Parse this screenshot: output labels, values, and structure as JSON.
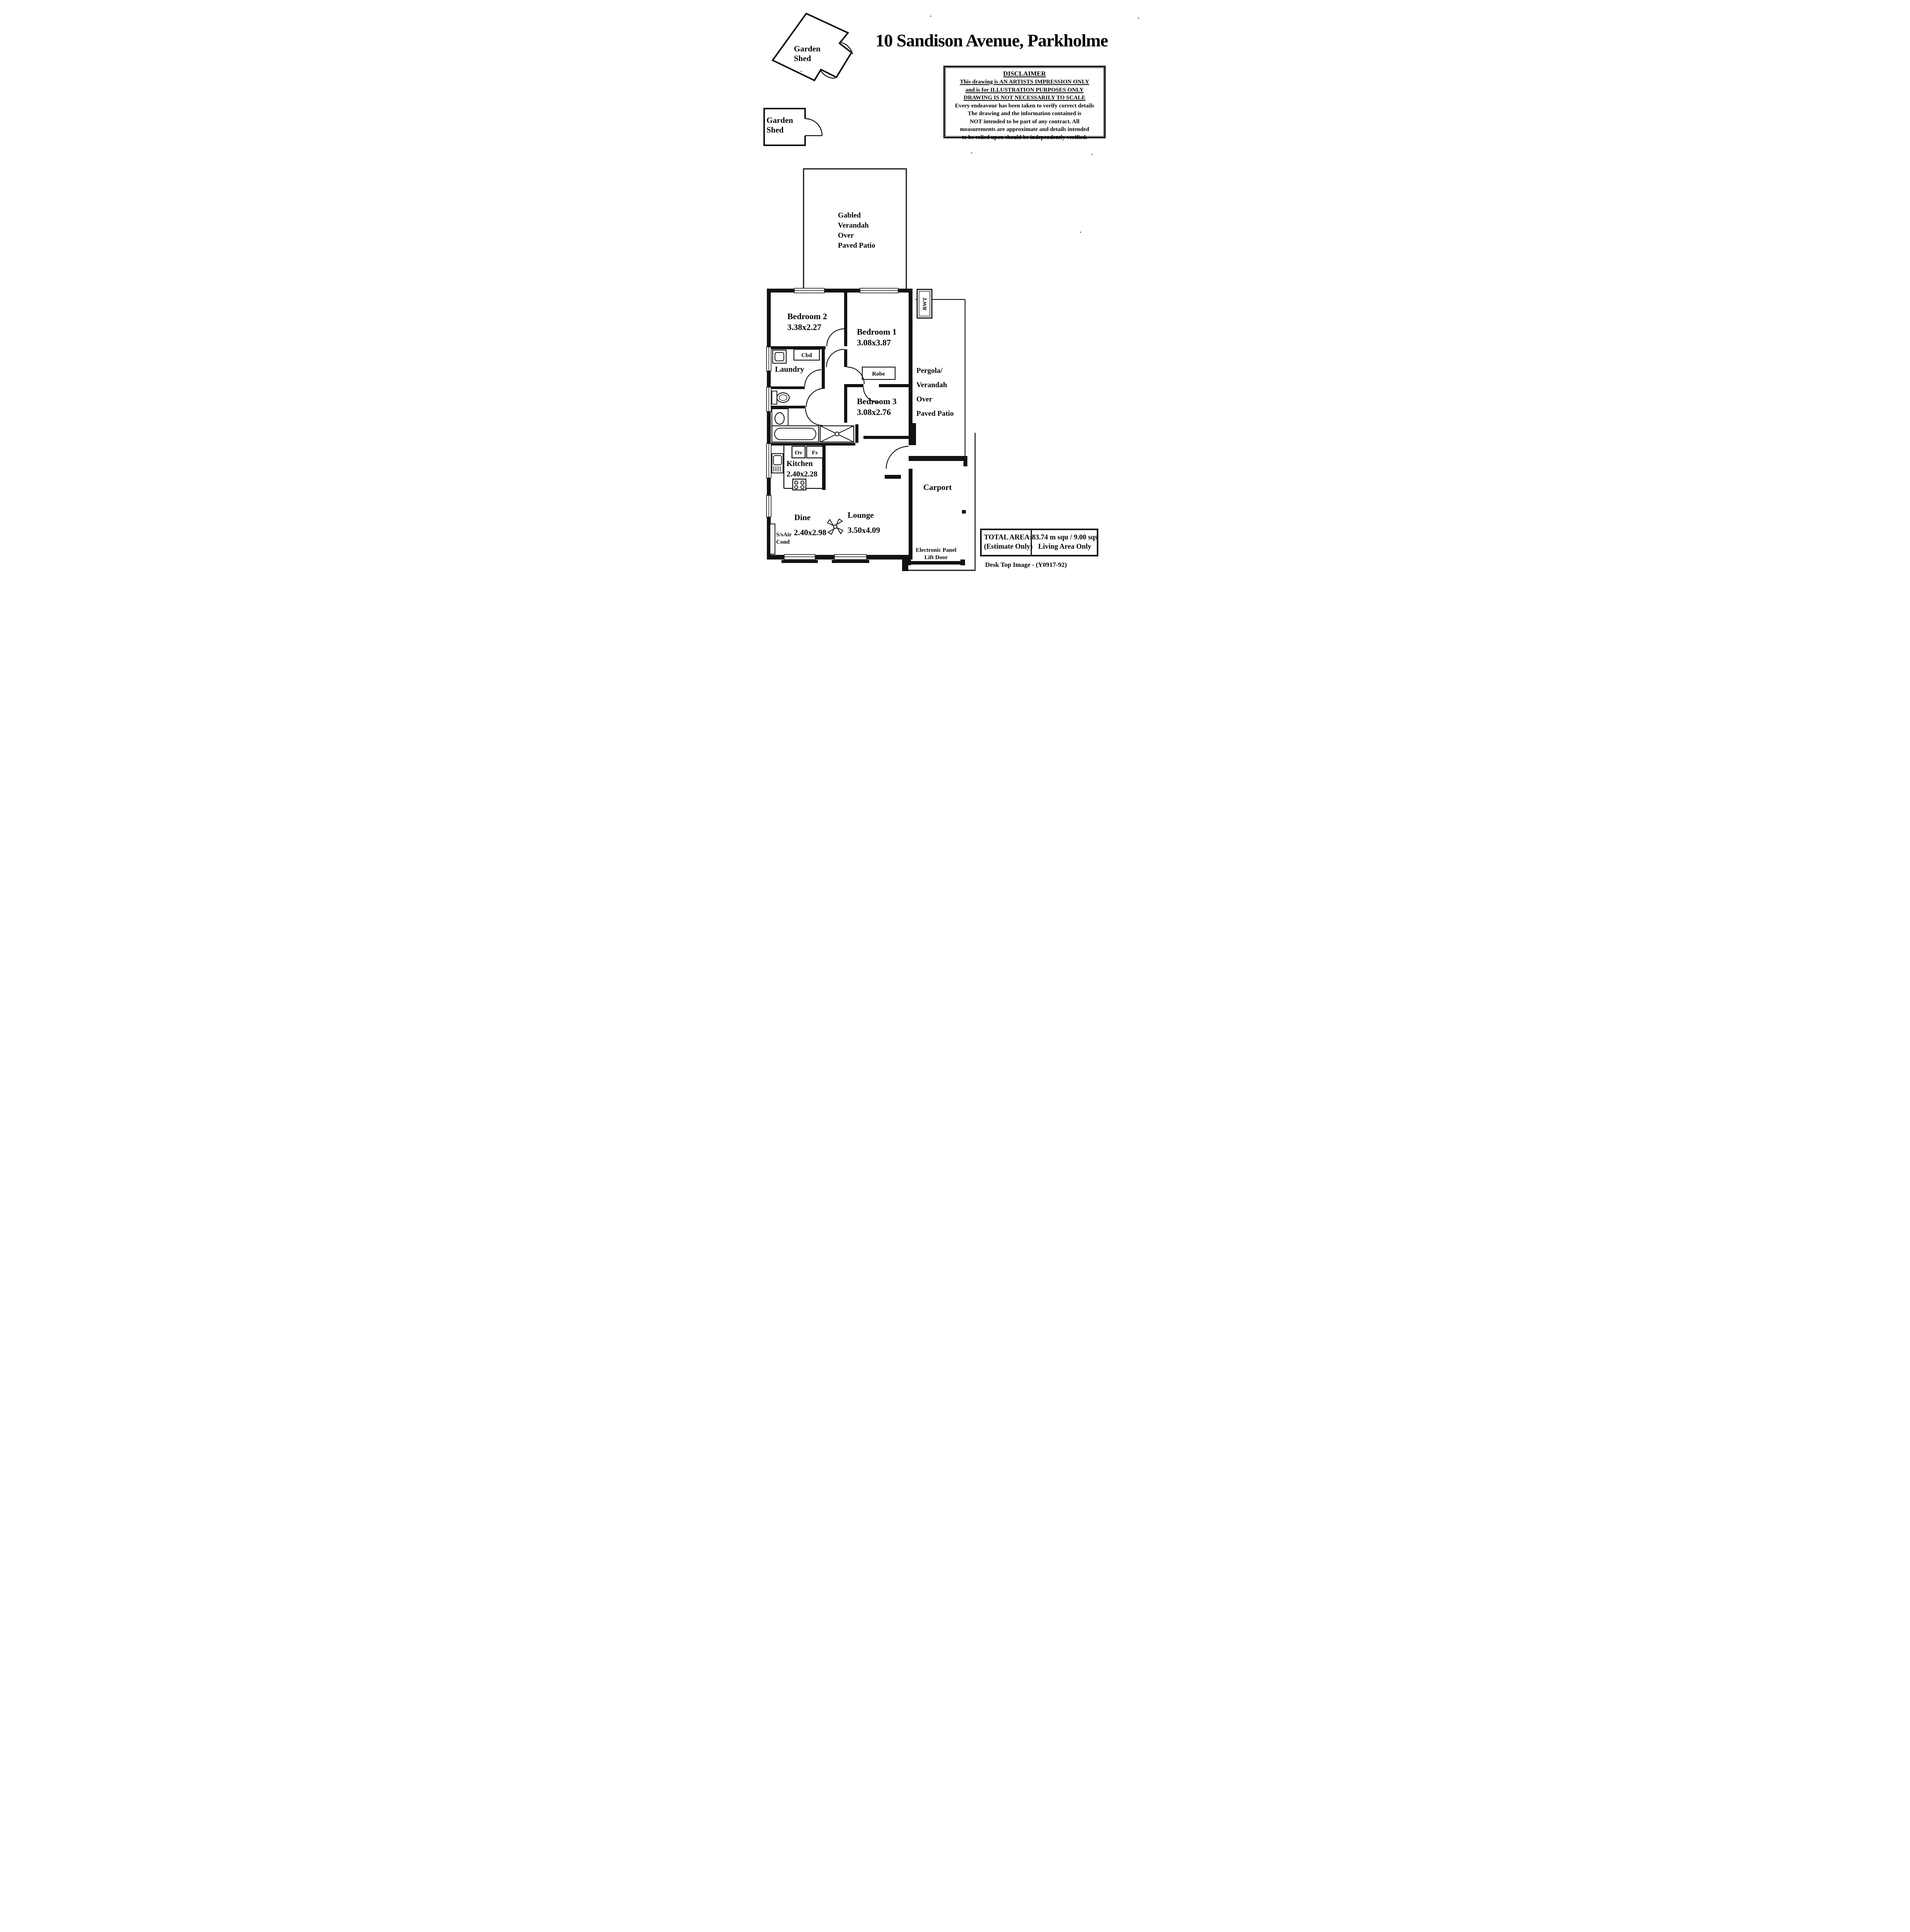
{
  "page": {
    "title": "10 Sandison Avenue, Parkholme",
    "footer": "Desk Top Image - (Y0917-92)"
  },
  "disclaimer": {
    "heading": "DISCLAIMER",
    "underlined": [
      "This drawing is AN ARTISTS IMPRESSION ONLY",
      "and is for ILLUSTRATION PURPOSES ONLY",
      "DRAWING IS NOT NECESSARILY TO SCALE"
    ],
    "body": [
      "Every endeavour has been taken to verify correct details",
      "The drawing and the information contained is",
      "NOT intended to be part of any contract. All",
      "measurements are approximate and details intended",
      "to be relied upon should be independently verified."
    ]
  },
  "outbuildings": {
    "shed1": {
      "line1": "Garden",
      "line2": "Shed"
    },
    "shed2": {
      "line1": "Garden",
      "line2": "Shed"
    }
  },
  "verandah": {
    "lines": [
      "Gabled",
      "Verandah",
      "Over",
      "Paved Patio"
    ]
  },
  "pergola": {
    "lines": [
      "Pergola/",
      "Verandah",
      "Over",
      "Paved Patio"
    ]
  },
  "rooms": {
    "bedroom1": {
      "name": "Bedroom 1",
      "dims": "3.08x3.87"
    },
    "bedroom2": {
      "name": "Bedroom 2",
      "dims": "3.38x2.27"
    },
    "bedroom3": {
      "name": "Bedroom 3",
      "dims": "3.08x2.76"
    },
    "kitchen": {
      "name": "Kitchen",
      "dims": "2.40x2.28"
    },
    "dine": {
      "name": "Dine",
      "dims": "2.40x2.98"
    },
    "lounge": {
      "name": "Lounge",
      "dims": "3.50x4.09"
    },
    "laundry": {
      "name": "Laundry"
    },
    "carport": {
      "name": "Carport"
    }
  },
  "fixtures": {
    "cbd": "Cbd",
    "robe": "Robe",
    "ov": "Ov",
    "fs": "Fs",
    "rwt": "RWT",
    "aircon_line1": "S/sAir",
    "aircon_line2": "Cond",
    "door_line1": "Electronic Panel",
    "door_line2": "Lift Door"
  },
  "total_area": {
    "label_line1": "TOTAL AREA:",
    "label_line2": "(Estimate Only)",
    "value_line1": "83.74 m squ / 9.00 sqs",
    "value_line2": "Living Area Only"
  }
}
